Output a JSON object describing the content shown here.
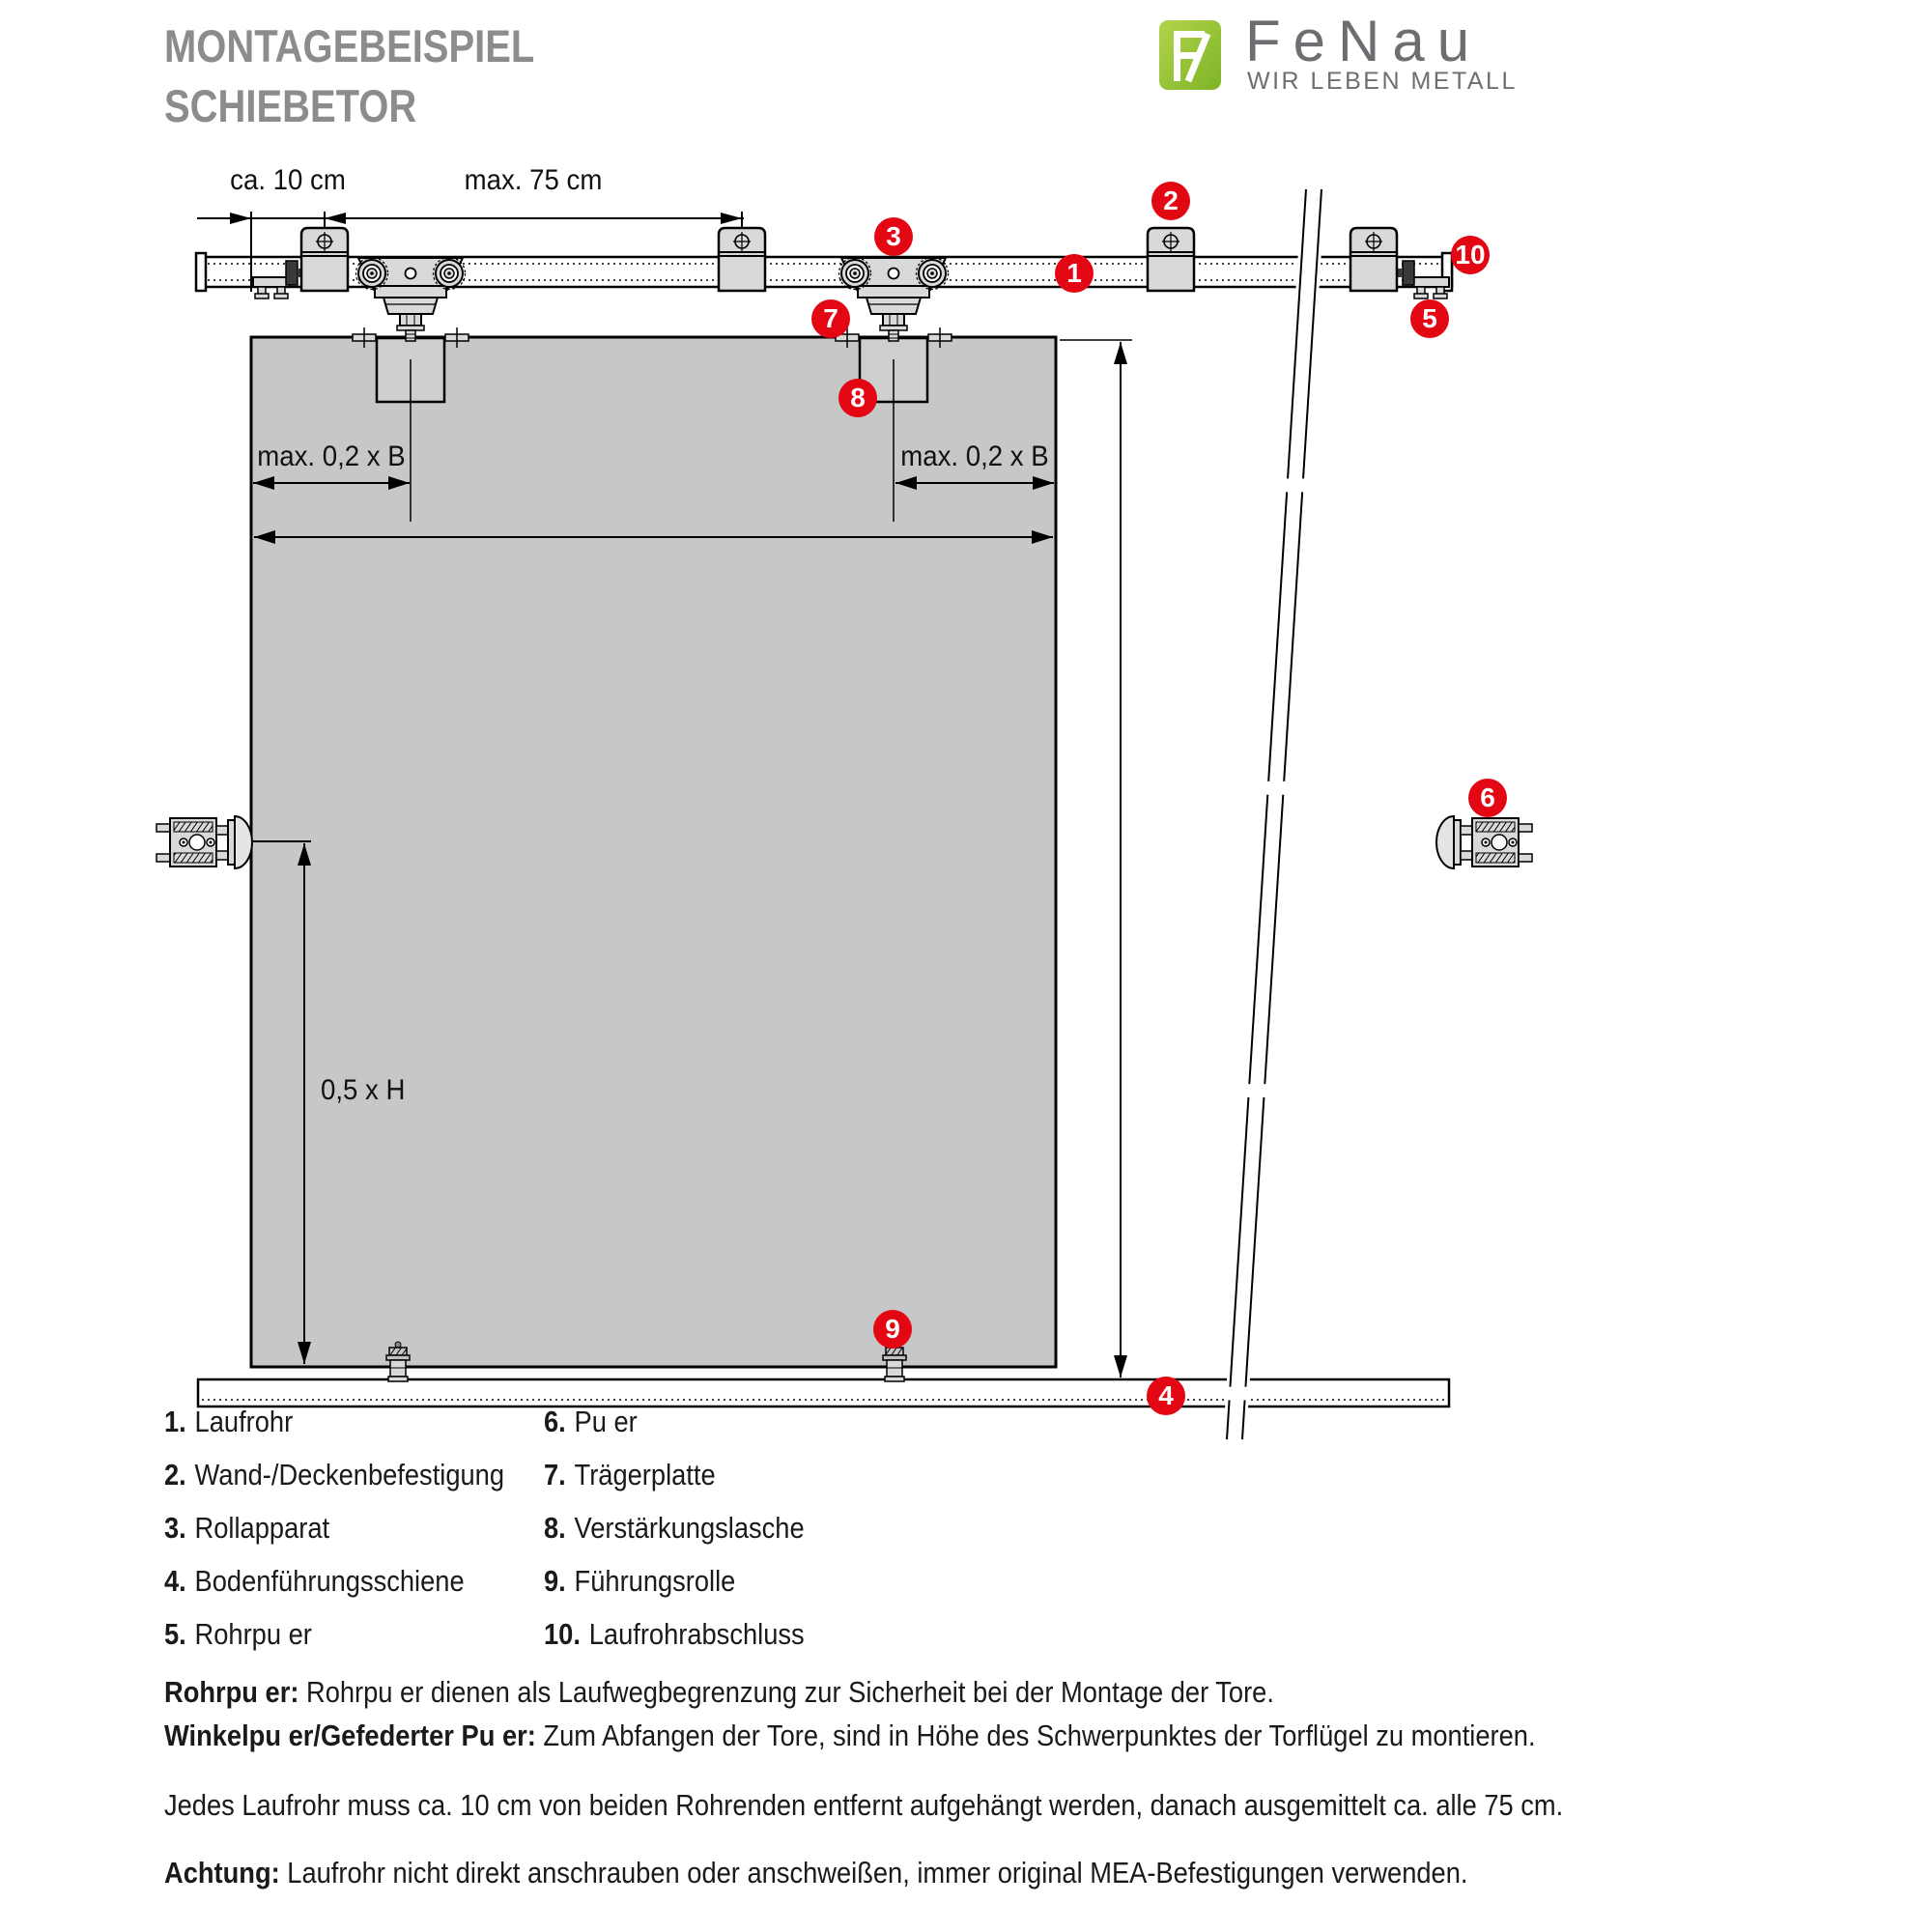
{
  "header": {
    "title_line1": "MONTAGEBEISPIEL",
    "title_line2": "SCHIEBETOR",
    "logo": {
      "brand": "FeNau",
      "tagline": "WIR LEBEN METALL"
    }
  },
  "colors": {
    "accent_red": "#e30613",
    "logo_green": "#95c11f",
    "logo_text_gray": "#6d6e71",
    "title_gray": "#8c8c8c",
    "door_gray": "#c6c7c9",
    "part_gray": "#d8d9db"
  },
  "diagram": {
    "dims": {
      "top_left": "ca. 10 cm",
      "top_span": "max. 75 cm",
      "door_left": "max. 0,2 x B",
      "door_right": "max. 0,2 x B",
      "height_half": "0,5 x H"
    },
    "callouts": [
      "1",
      "2",
      "3",
      "4",
      "5",
      "6",
      "7",
      "8",
      "9",
      "10"
    ]
  },
  "legend": {
    "col1": [
      {
        "num": "1.",
        "label": "Laufrohr"
      },
      {
        "num": "2.",
        "label": "Wand-/Deckenbefestigung"
      },
      {
        "num": "3.",
        "label": "Rollapparat"
      },
      {
        "num": "4.",
        "label": "Bodenführungsschiene"
      },
      {
        "num": "5.",
        "label": "Rohrpu er"
      }
    ],
    "col2": [
      {
        "num": "6.",
        "label": "Pu er"
      },
      {
        "num": "7.",
        "label": "Trägerplatte"
      },
      {
        "num": "8.",
        "label": "Verstärkungslasche"
      },
      {
        "num": "9.",
        "label": "Führungsrolle"
      },
      {
        "num": "10.",
        "label": "Laufrohrabschluss"
      }
    ]
  },
  "notes": [
    {
      "lead": "Rohrpu er:",
      "text": " Rohrpu er dienen als Laufwegbegrenzung zur Sicherheit bei der Montage der Tore."
    },
    {
      "lead": "Winkelpu er/Gefederter Pu er:",
      "text": " Zum Abfangen der Tore, sind in Höhe des Schwerpunktes der Torflügel zu montieren."
    },
    {
      "lead": "",
      "text": "Jedes Laufrohr muss ca. 10 cm von beiden Rohrenden entfernt aufgehängt werden, danach ausgemittelt ca. alle 75 cm."
    },
    {
      "lead": "Achtung:",
      "text": " Laufrohr nicht direkt anschrauben oder anschweißen, immer original MEA-Befestigungen verwenden."
    }
  ]
}
